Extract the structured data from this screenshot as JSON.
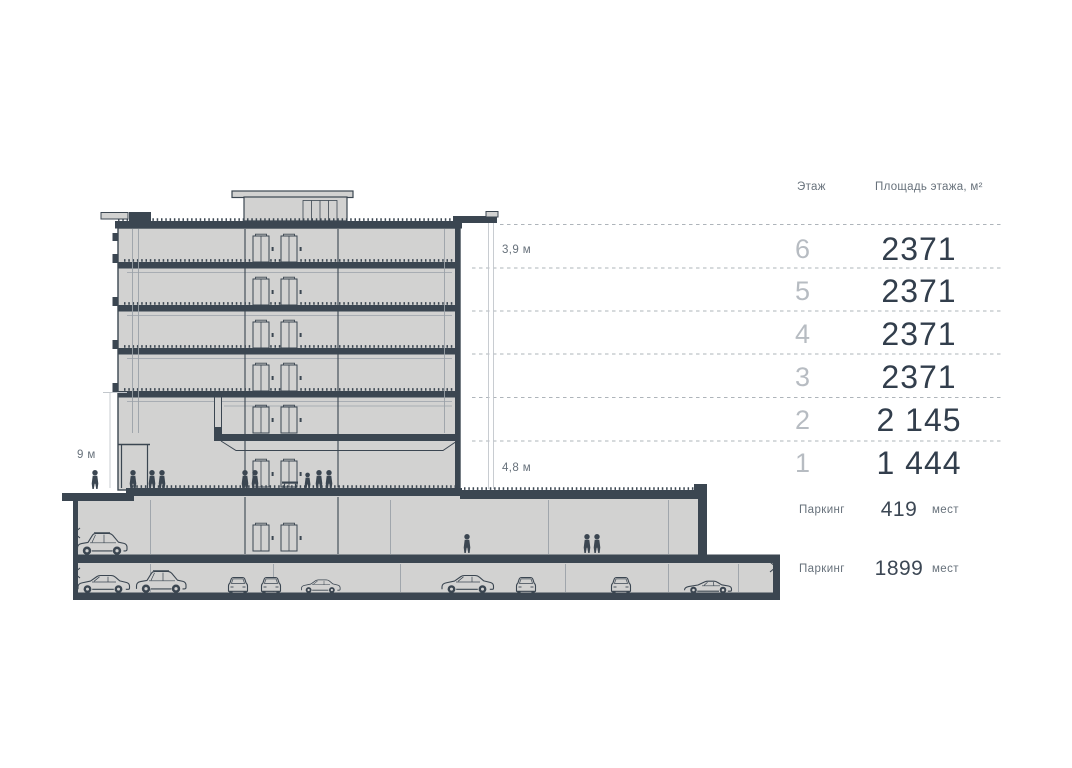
{
  "table": {
    "col_floor": "Этаж",
    "col_area": "Площадь этажа, м²",
    "rows": [
      {
        "floor": "6",
        "area": "2371"
      },
      {
        "floor": "5",
        "area": "2371"
      },
      {
        "floor": "4",
        "area": "2371"
      },
      {
        "floor": "3",
        "area": "2371"
      },
      {
        "floor": "2",
        "area": "2 145"
      },
      {
        "floor": "1",
        "area": "1 444"
      }
    ],
    "parking": [
      {
        "label": "Паркинг",
        "value": "419",
        "unit": "мест"
      },
      {
        "label": "Паркинг",
        "value": "1899",
        "unit": "мест"
      }
    ]
  },
  "dimensions": {
    "typical_floor": "3,9 м",
    "lobby_height": "9 м",
    "ground_floor": "4,8 м"
  },
  "colors": {
    "ink": "#3b4651",
    "building_fill": "#d2d2d1",
    "muted_text": "#67717b",
    "faint_text": "#b7bcc2",
    "value_text": "#323e4c"
  }
}
